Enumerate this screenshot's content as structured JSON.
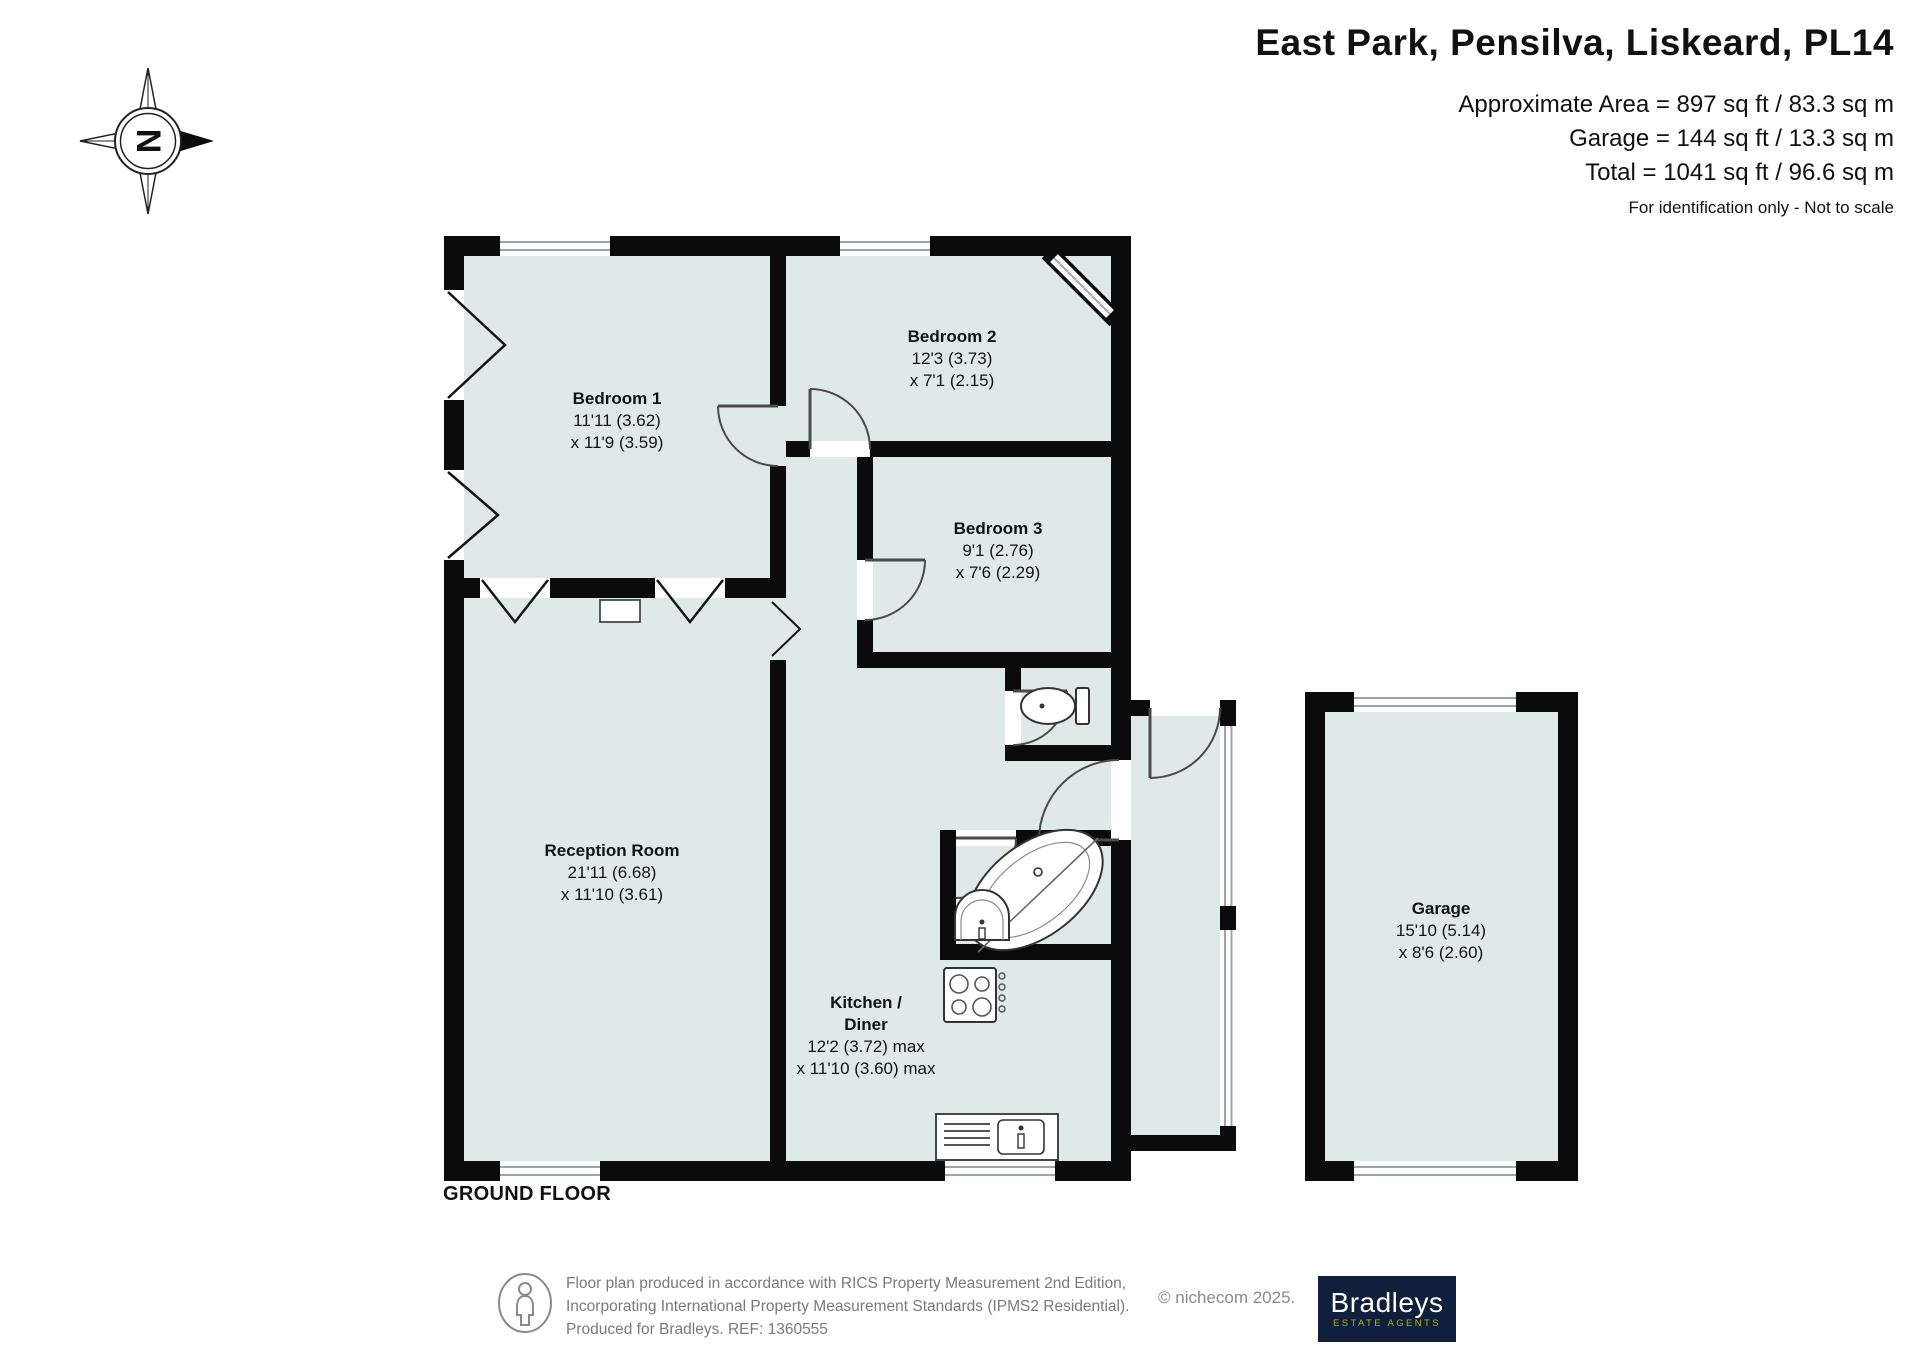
{
  "header": {
    "title": "East Park, Pensilva, Liskeard, PL14",
    "area_lines": [
      "Approximate Area = 897 sq ft / 83.3 sq m",
      "Garage  = 144 sq ft / 13.3 sq m",
      "Total = 1041 sq ft / 96.6 sq m"
    ],
    "disclaimer": "For identification only - Not to scale"
  },
  "compass": {
    "north_label": "N"
  },
  "floor": {
    "label": "GROUND FLOOR"
  },
  "rooms": [
    {
      "name": "Bedroom 1",
      "dim1": "11'11 (3.62)",
      "dim2": "x 11'9 (3.59)"
    },
    {
      "name": "Bedroom 2",
      "dim1": "12'3 (3.73)",
      "dim2": "x 7'1 (2.15)"
    },
    {
      "name": "Bedroom 3",
      "dim1": "9'1 (2.76)",
      "dim2": "x 7'6 (2.29)"
    },
    {
      "name": "Reception Room",
      "dim1": "21'11 (6.68)",
      "dim2": "x 11'10 (3.61)"
    },
    {
      "name": "Kitchen /",
      "name2": "Diner",
      "dim1": "12'2 (3.72) max",
      "dim2": "x 11'10 (3.60) max"
    },
    {
      "name": "Garage",
      "dim1": "15'10 (5.14)",
      "dim2": "x 8'6 (2.60)"
    }
  ],
  "footer": {
    "line1": "Floor plan produced in accordance with RICS Property Measurement 2nd Edition,",
    "line2": "Incorporating International Property Measurement Standards (IPMS2 Residential).",
    "line3": "Produced for Bradleys.   REF: 1360555",
    "copyright": "© nichecom 2025."
  },
  "logo": {
    "brand": "Bradleys",
    "tagline": "ESTATE AGENTS"
  },
  "colors": {
    "floor_fill": "#dfe9e9",
    "wall": "#0b0b0b",
    "logo_background": "#101f3c",
    "logo_gold": "#b3b000",
    "footer_text": "#7a7a7a"
  }
}
